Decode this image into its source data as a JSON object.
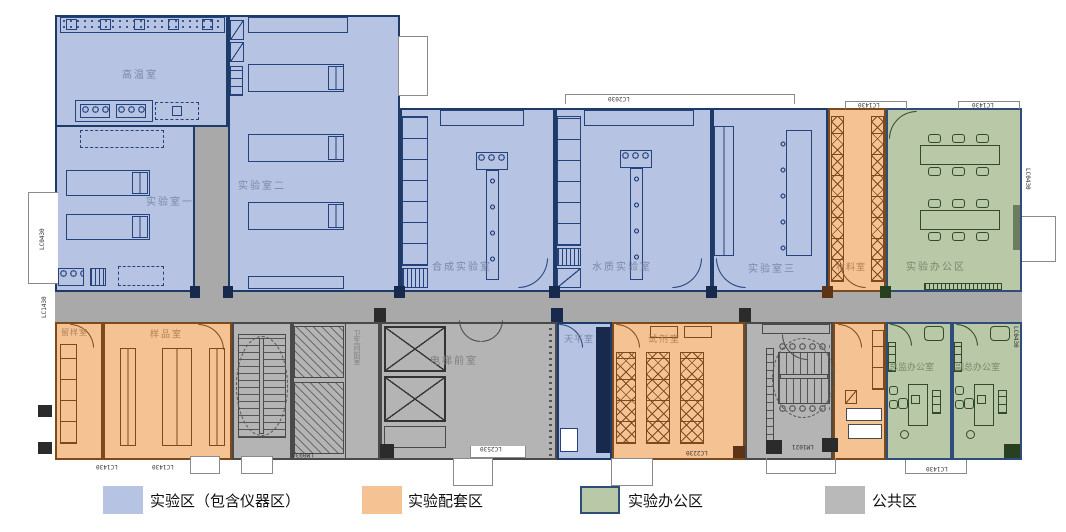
{
  "rooms": {
    "high_temp": {
      "label": "高温室"
    },
    "lab_one": {
      "label": "实验室一"
    },
    "lab_two": {
      "label": "实验室二"
    },
    "synthesis": {
      "label": "合成实验室"
    },
    "water_quality": {
      "label": "水质实验室"
    },
    "lab_three": {
      "label": "实验室三"
    },
    "material": {
      "label": "材料室"
    },
    "lab_office_area": {
      "label": "实验办公区"
    },
    "sample_retention": {
      "label": "留样室"
    },
    "sample": {
      "label": "样品室"
    },
    "toilet_front": {
      "label": "卫生间前室"
    },
    "elevator_lobby": {
      "label": "电梯前室"
    },
    "balance": {
      "label": "天平室"
    },
    "reagent": {
      "label": "试剂室"
    },
    "director_office": {
      "label": "总监办公室"
    },
    "deputy_office": {
      "label": "副总办公室"
    }
  },
  "legend": {
    "items": [
      {
        "label": "实验区（包含仪器区）",
        "color": "#b6c3e2"
      },
      {
        "label": "实验配套区",
        "color": "#f5c293"
      },
      {
        "label": "实验办公区",
        "color": "#b9c8a6",
        "border": "#2e4d7b"
      },
      {
        "label": "公共区",
        "color": "#b9b9b9"
      }
    ]
  },
  "zone_colors": {
    "lab": "#b6c3e2",
    "support": "#f5c293",
    "office": "#b9c8a6",
    "public": "#a9a9a9"
  },
  "annotations": [
    {
      "text": "LC2030"
    },
    {
      "text": "LC1430"
    },
    {
      "text": "LC1430"
    },
    {
      "text": "LC0430"
    },
    {
      "text": "LC1430"
    },
    {
      "text": "LC0430"
    },
    {
      "text": "LC1430"
    },
    {
      "text": "LC1430"
    },
    {
      "text": "LM0930"
    },
    {
      "text": "LC2530"
    },
    {
      "text": "LC2230"
    },
    {
      "text": "LM1021"
    },
    {
      "text": "LC1430"
    },
    {
      "text": "LC0430"
    }
  ]
}
